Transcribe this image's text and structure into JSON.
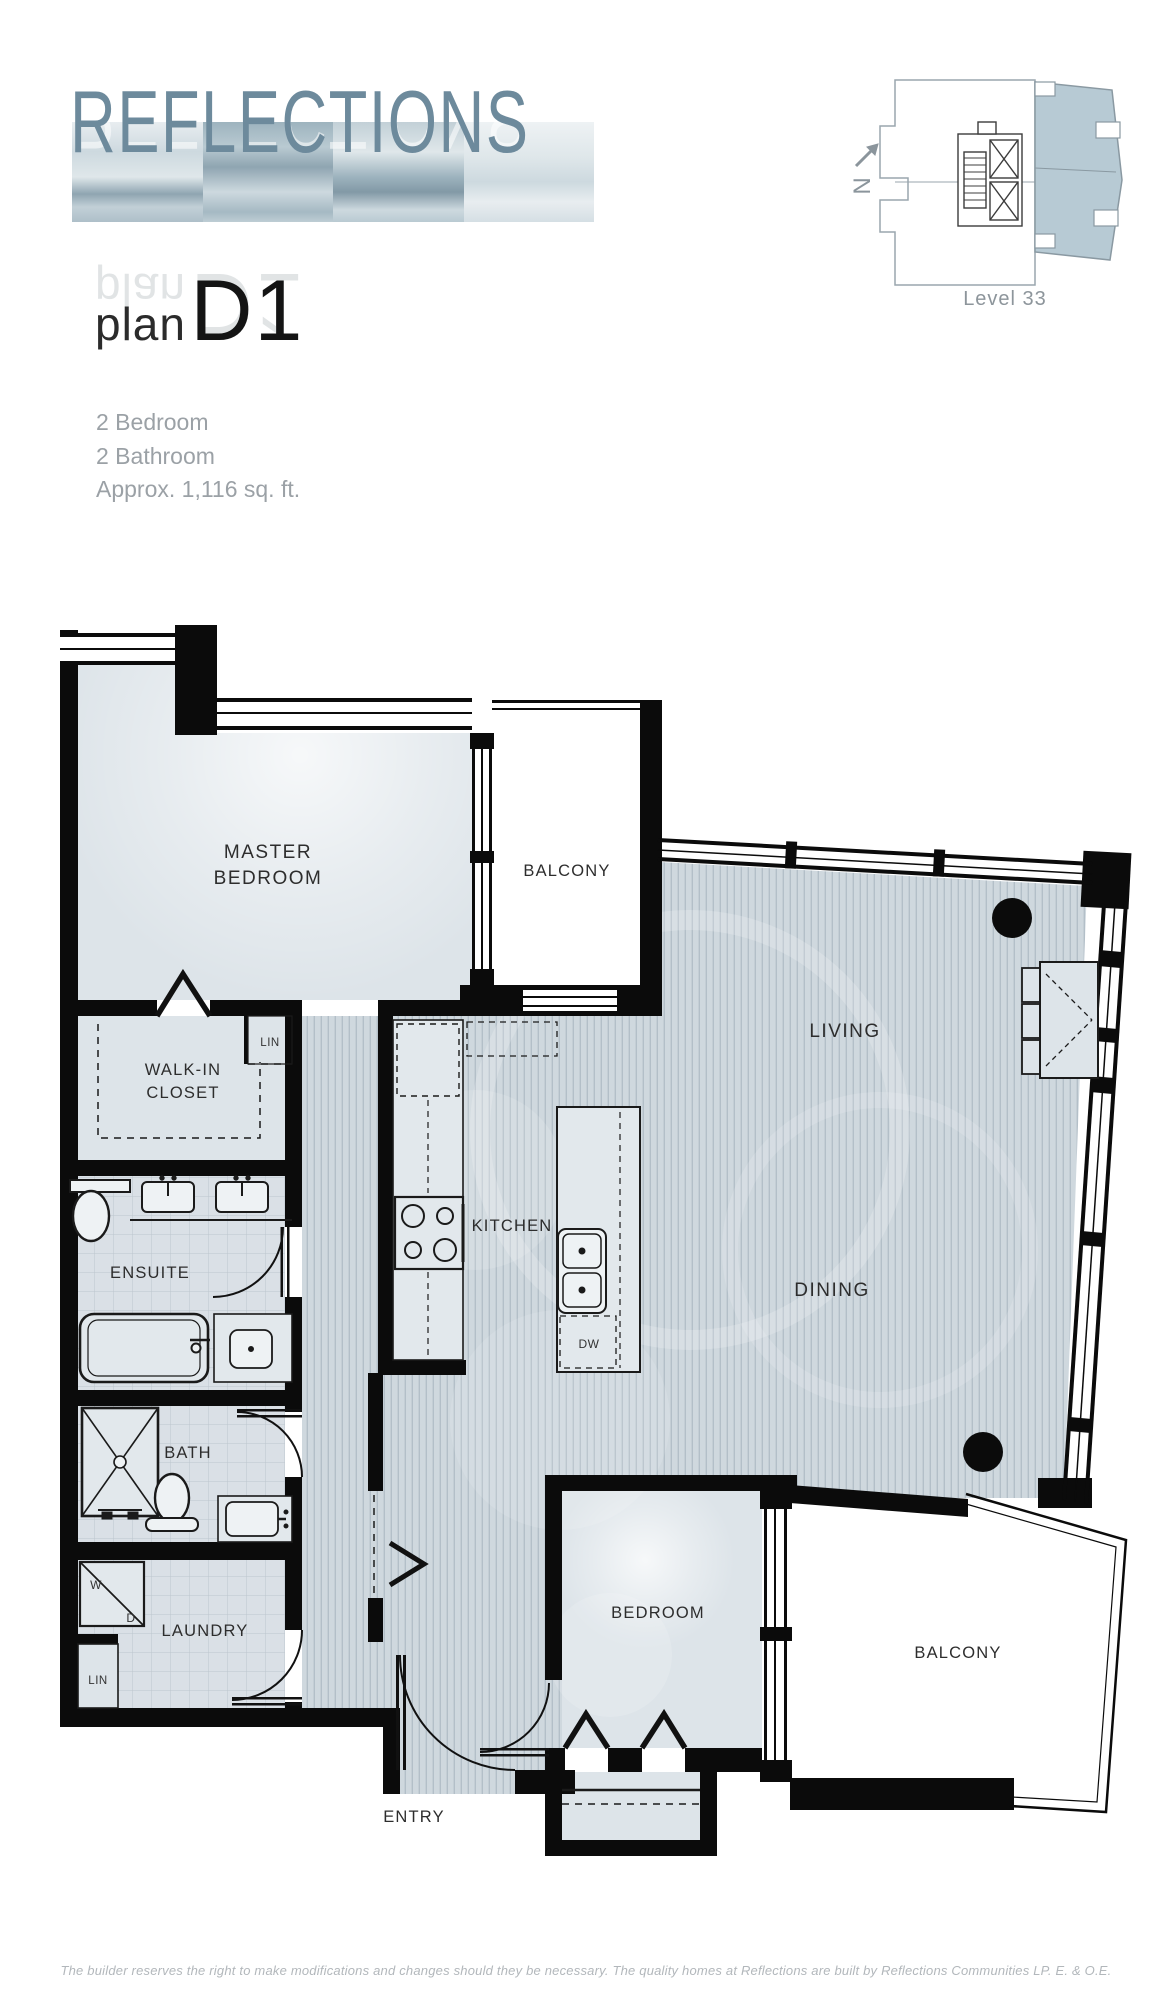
{
  "header": {
    "logo": "REFLECTIONS",
    "plan_label": "plan",
    "plan_code": "D1",
    "specs": [
      "2 Bedroom",
      "2 Bathroom",
      "Approx. 1,116 sq. ft."
    ]
  },
  "keyplan": {
    "north": "N",
    "level": "Level 33"
  },
  "rooms": {
    "master_line1": "MASTER",
    "master_line2": "BEDROOM",
    "balcony_top": "BALCONY",
    "walkin_line1": "WALK-IN",
    "walkin_line2": "CLOSET",
    "lin_upper": "LIN",
    "ensuite": "ENSUITE",
    "kitchen": "KITCHEN",
    "living": "LIVING",
    "dining": "DINING",
    "bath": "BATH",
    "laundry": "LAUNDRY",
    "washer": "W",
    "dryer": "D",
    "lin_lower": "LIN",
    "entry": "ENTRY",
    "bedroom": "BEDROOM",
    "balcony_bottom": "BALCONY",
    "dishwasher": "DW"
  },
  "footer": {
    "disclaimer": "The builder reserves the right to make modifications and changes should they be necessary. The quality homes at Reflections are built by Reflections Communities LP. E. & O.E."
  },
  "colors": {
    "brand": "#6d8a9c",
    "wall": "#0b0b0b",
    "room_fill": "#dde4e9",
    "floor_stripe": "#cfd8de",
    "tile": "#dae0e6",
    "keyplan_unit": "#b7cad4"
  }
}
